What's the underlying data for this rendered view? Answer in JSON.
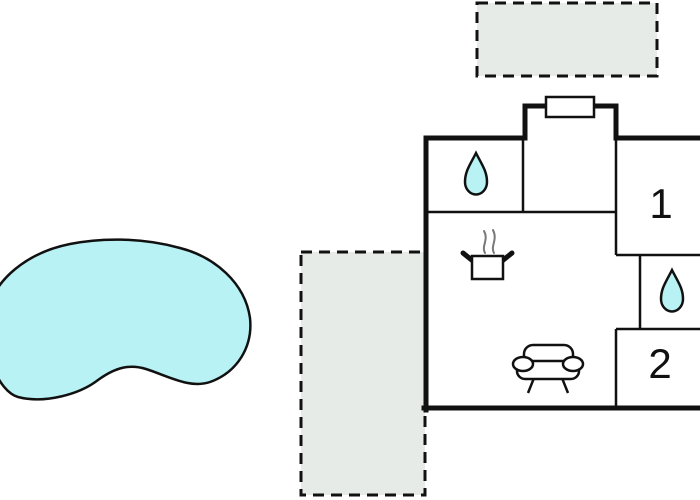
{
  "colors": {
    "background": "#ffffff",
    "wall": "#111111",
    "water": "#b9f2f5",
    "terrace_fill": "#e6ebe8",
    "steam": "#787878"
  },
  "rooms": {
    "room1_label": "1",
    "room2_label": "2"
  },
  "icons": {
    "bathroom_top": "water-drop-icon",
    "bathroom_right": "water-drop-icon",
    "kitchen": "cooking-pot-icon",
    "living_room": "sofa-icon"
  }
}
